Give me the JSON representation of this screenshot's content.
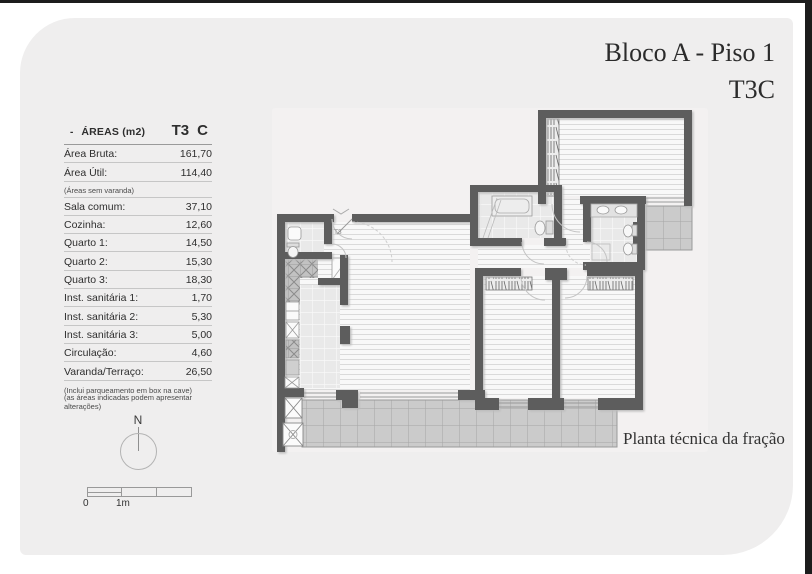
{
  "header": {
    "block_title": "Bloco A - Piso 1",
    "fraction_title": "T3C"
  },
  "areas_table": {
    "bullet": "-",
    "title": "ÁREAS (m2)",
    "typology": "T3",
    "fraction_letter": "C",
    "rows": [
      {
        "label": "Área Bruta:",
        "value": "161,70"
      },
      {
        "label": "Área Útil:",
        "value": "114,40"
      },
      {
        "label": "Sala comum:",
        "value": "37,10"
      },
      {
        "label": "Cozinha:",
        "value": "12,60"
      },
      {
        "label": "Quarto 1:",
        "value": "14,50"
      },
      {
        "label": "Quarto 2:",
        "value": "15,30"
      },
      {
        "label": "Quarto 3:",
        "value": "18,30"
      },
      {
        "label": "Inst. sanitária 1:",
        "value": "1,70"
      },
      {
        "label": "Inst. sanitária 2:",
        "value": "5,30"
      },
      {
        "label": "Inst. sanitária 3:",
        "value": "5,00"
      },
      {
        "label": "Circulação:",
        "value": "4,60"
      },
      {
        "label": "Varanda/Terraço:",
        "value": "26,50"
      }
    ],
    "note_after_util": "(Áreas sem varanda)",
    "footnote1": "(Inclui parqueamento em box na cave)",
    "footnote2": "(as áreas indicadas podem apresentar alterações)"
  },
  "compass": {
    "north_label": "N"
  },
  "scale_bar": {
    "start_label": "0",
    "end_label": "1m"
  },
  "plan": {
    "entry_label": "T3"
  },
  "footer": {
    "caption": "Planta técnica da fração"
  },
  "colors": {
    "panel": "#efeeee",
    "wall": "#5d5d5d",
    "terrace_tile": "#cbcbcb",
    "frame": "#1c1c1c"
  }
}
